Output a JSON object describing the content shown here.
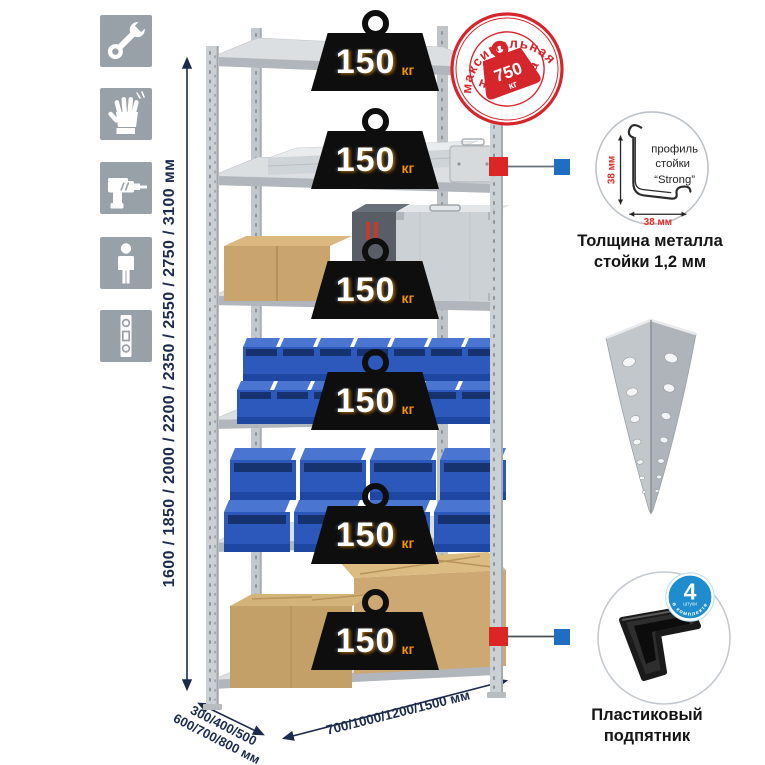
{
  "icons": [
    {
      "name": "wrench-icon"
    },
    {
      "name": "gloves-icon"
    },
    {
      "name": "drill-icon"
    },
    {
      "name": "person-icon"
    },
    {
      "name": "level-icon"
    }
  ],
  "dimensions": {
    "height": "1600 / 1850 / 2000 / 2200 / 2350 / 2550 / 2750 / 3100 мм",
    "depth_line1": "300/400/500",
    "depth_line2": "600/700/800 мм",
    "width": "700/1000/1200/1500 мм"
  },
  "stamp": {
    "arc_top": "максимальная",
    "arc_bottom": "нагрузка",
    "value": "750",
    "unit": "кг"
  },
  "shelf_load": {
    "value": "150",
    "unit": "кг",
    "shelf_count": 6
  },
  "profile": {
    "line1": "профиль",
    "line2": "стойки",
    "line3": "“Strong”",
    "dim_v": "38 мм",
    "dim_h": "38 мм",
    "caption1": "Толщина металла",
    "caption2": "стойки 1,2 мм"
  },
  "foot": {
    "badge": "4",
    "badge_sub": "штуки",
    "badge_arc": "в комплекте",
    "caption1": "Пластиковый",
    "caption2": "подпятник"
  },
  "colors": {
    "accent_red": "#d5262c",
    "navy": "#1c2b4d",
    "bin_blue": "#2c59bb",
    "badge_blue": "#1e8ccd",
    "orange": "#f39200",
    "marker_red": "#dc2626",
    "marker_blue": "#1f6ec2"
  }
}
